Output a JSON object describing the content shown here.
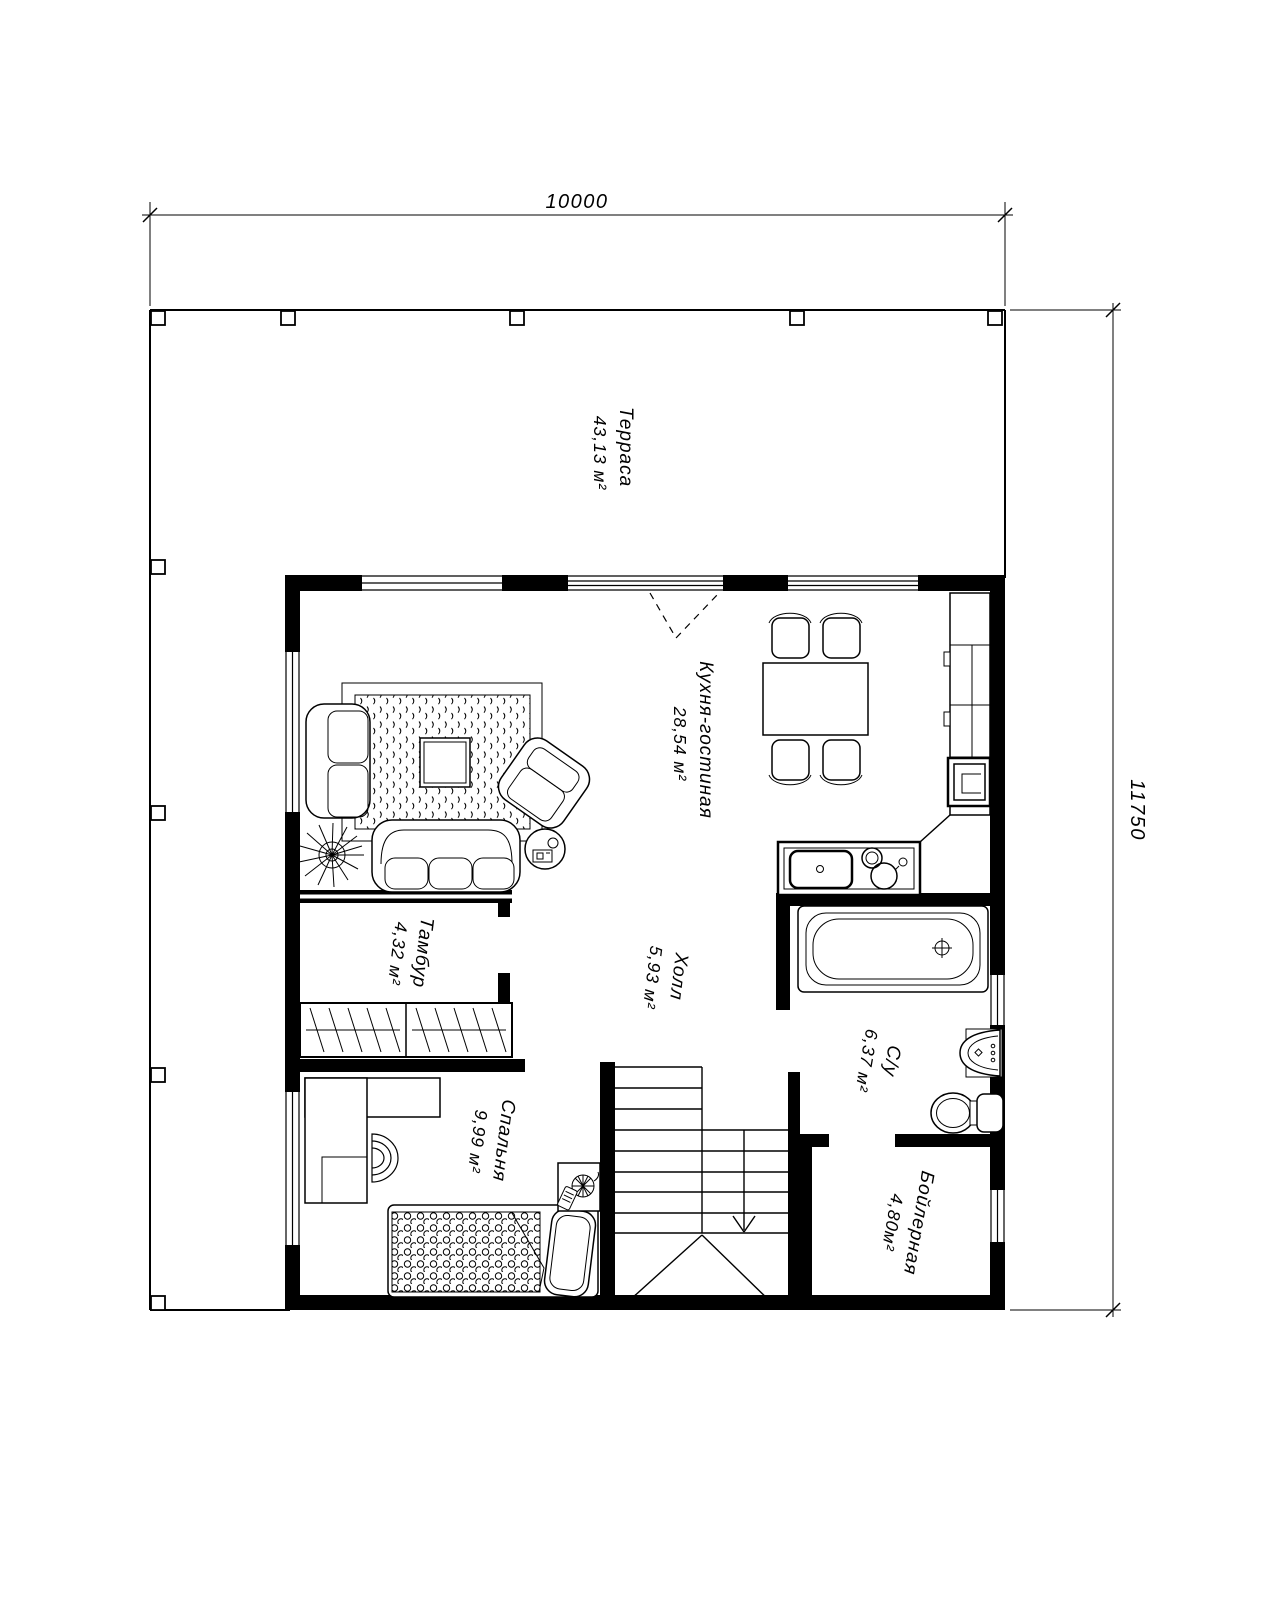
{
  "dimensions": {
    "top": "10000",
    "right": "11750"
  },
  "rooms": {
    "terrace": {
      "name": "Терраса",
      "area": "43,13 м²"
    },
    "kitchen_living": {
      "name": "Кухня-гостиная",
      "area": "28,54 м²"
    },
    "tambour": {
      "name": "Тамбур",
      "area": "4,32 м²"
    },
    "hall": {
      "name": "Холл",
      "area": "5,93 м²"
    },
    "bathroom": {
      "name": "С/у",
      "area": "6,37 м²"
    },
    "bedroom": {
      "name": "Спальня",
      "area": "9,99 м²"
    },
    "boiler": {
      "name": "Бойлерная",
      "area": "4,80м²"
    }
  },
  "colors": {
    "line": "#000000",
    "background": "#ffffff"
  }
}
